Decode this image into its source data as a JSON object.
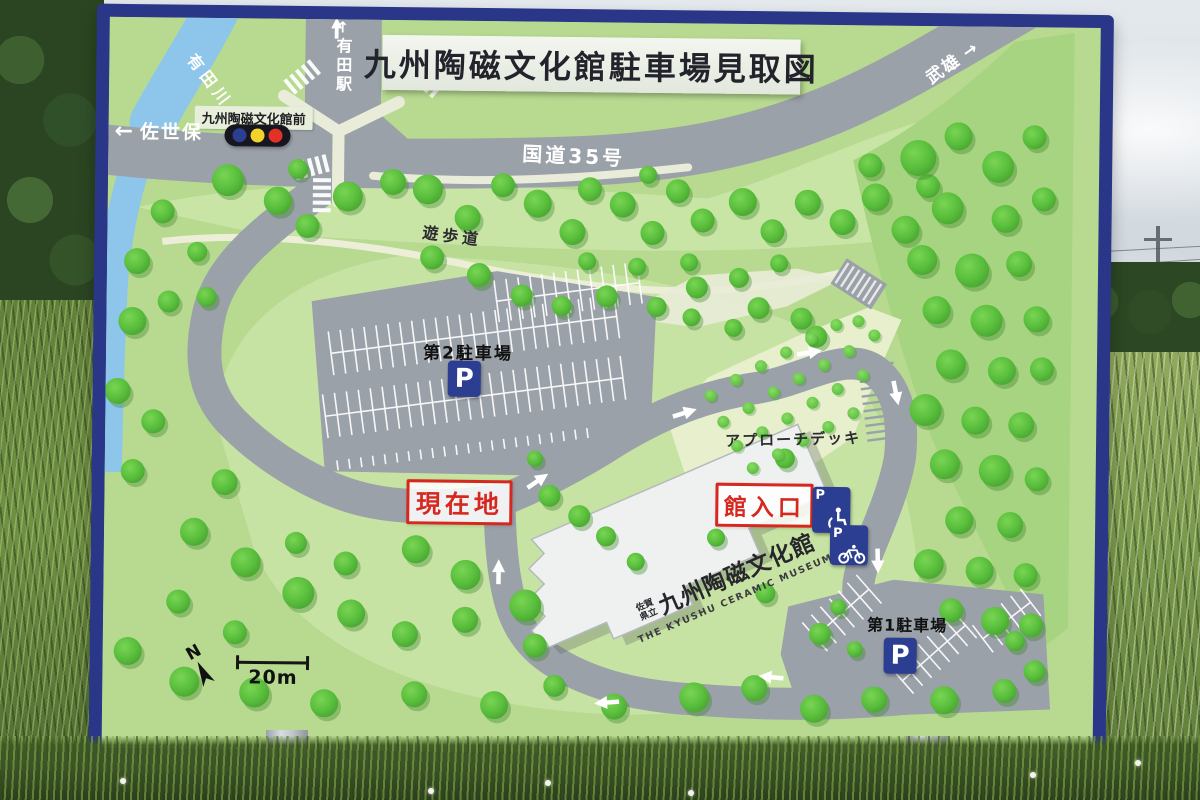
{
  "sign": {
    "title": "九州陶磁文化館駐車場見取図",
    "labels": {
      "river": "有田川",
      "station": "有田駅",
      "station_arrow": "↑",
      "bus_stop": "九州陶磁文化館前",
      "sasebo": "佐世保",
      "sasebo_arrow": "←",
      "route35": "国道35号",
      "takeo": "武雄",
      "takeo_arrow": "→",
      "promenade": "遊歩道",
      "parking2": "第2駐車場",
      "parking1": "第1駐車場",
      "p": "P",
      "deck": "アプローチデッキ",
      "current_location": "現在地",
      "entrance": "館入口",
      "museum_pref1": "佐賀",
      "museum_pref2": "県立",
      "museum_name": "九州陶磁文化館",
      "museum_en": "THE KYUSHU CERAMIC MUSEUM",
      "north": "N",
      "scale": "20m"
    }
  },
  "colors": {
    "frame_navy": "#2a3688",
    "sign_green": "#b7da90",
    "ground_pale": "#cde6aa",
    "forest_green": "#a7d480",
    "tree_green": "#58bd3c",
    "road_gray": "#9aa1a8",
    "path_cream": "#e9ecd8",
    "river_blue": "#8dc6ea",
    "marker_red": "#d6281f",
    "parking_blue": "#2b3e91",
    "signal_yellow": "#f3d22b",
    "signal_red": "#e23227",
    "signal_blue": "#2c3e8e"
  }
}
